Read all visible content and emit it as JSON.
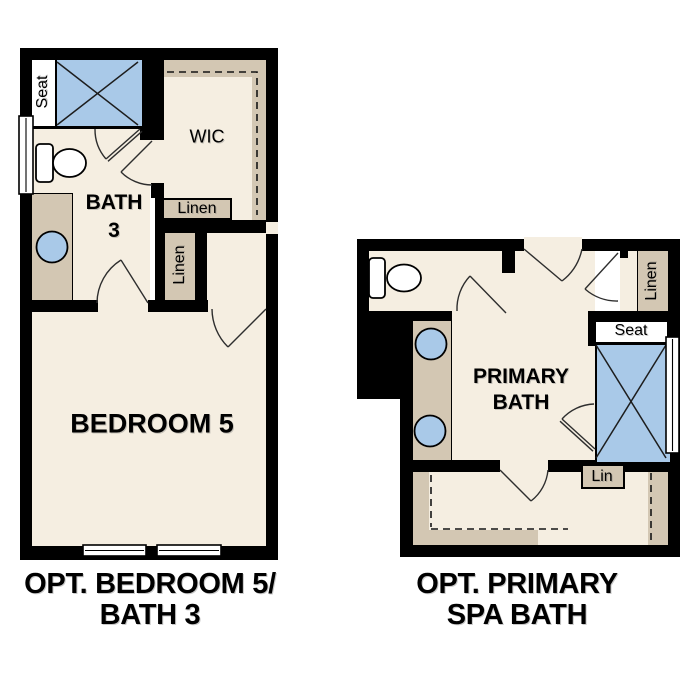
{
  "colors": {
    "bg": "#ffffff",
    "floor": "#f5eee1",
    "counter": "#d3c7b3",
    "shower": "#a9c9e8",
    "wall": "#000000"
  },
  "plans": {
    "bedroom5": {
      "caption": [
        "OPT. BEDROOM 5/",
        "BATH 3"
      ],
      "rooms": {
        "bedroom": "BEDROOM 5",
        "bath_line1": "BATH",
        "bath_line2": "3",
        "wic": "WIC"
      },
      "closets": {
        "linen_upper": "Linen",
        "linen_lower": "Linen"
      },
      "fixtures": {
        "shower_seat": "Seat"
      }
    },
    "primary": {
      "caption": [
        "OPT. PRIMARY",
        "SPA BATH"
      ],
      "rooms": {
        "bath_line1": "PRIMARY",
        "bath_line2": "BATH"
      },
      "closets": {
        "linen": "Linen",
        "lin": "Lin"
      },
      "fixtures": {
        "shower_seat": "Seat"
      }
    }
  }
}
